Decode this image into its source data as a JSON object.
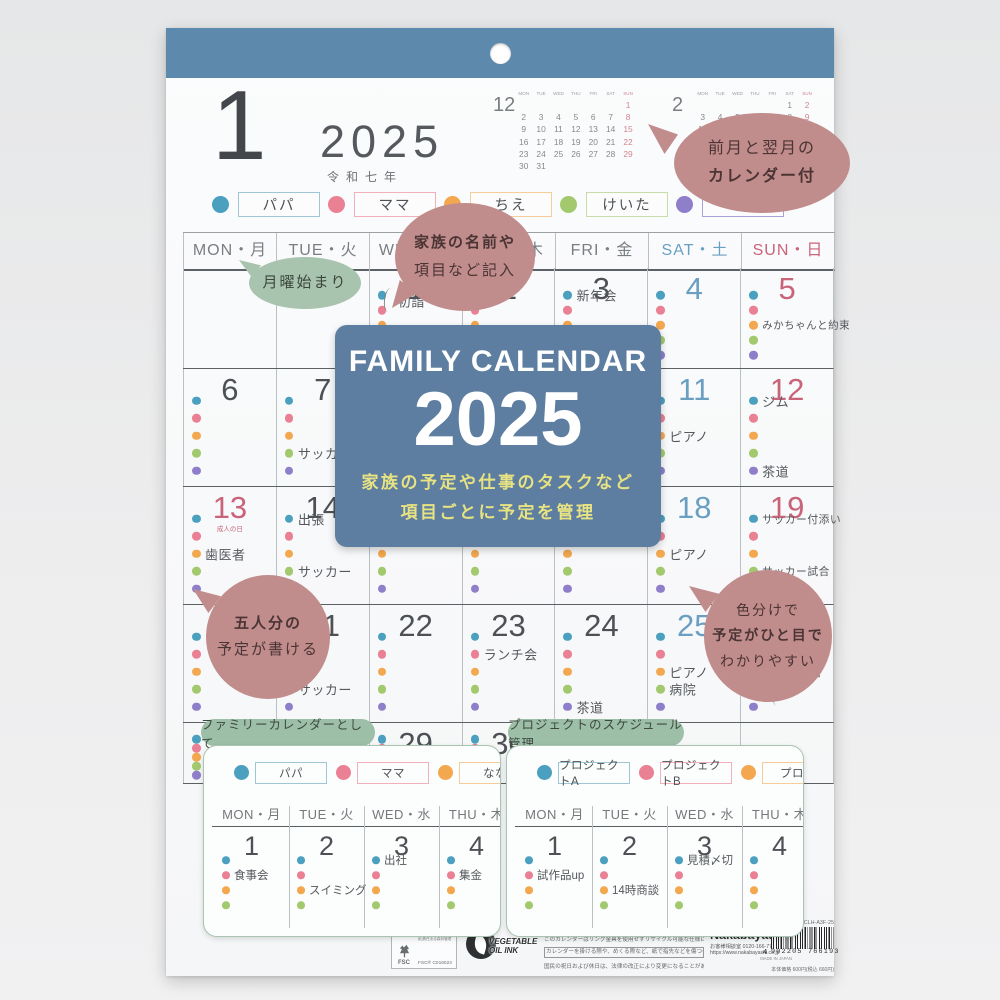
{
  "colors": {
    "strip": "#5d89ac",
    "card": "#5d7ea1",
    "card_accent": "#e7e282",
    "bubble_pink": "#c18c8c",
    "bubble_green": "#a9c4ae",
    "banner_green": "#9dbfa8",
    "members": [
      "#4ba0bf",
      "#ea8093",
      "#f3a74f",
      "#a3c96f",
      "#8f7ec9"
    ],
    "member_boxes": [
      "#9fc6d4",
      "#f2b0bc",
      "#f6cd99",
      "#c7dca6",
      "#a9a2d8"
    ],
    "sat": "#6b9fc2",
    "sun": "#c96379"
  },
  "header": {
    "month": "1",
    "year": "2025",
    "era": "令和七年"
  },
  "mini_calendars": [
    {
      "month": "12",
      "weekdays": [
        "MON",
        "TUE",
        "WED",
        "THU",
        "FRI",
        "SAT",
        "SUN"
      ],
      "weeks": [
        [
          "",
          "",
          "",
          "",
          "",
          "",
          "1"
        ],
        [
          "2",
          "3",
          "4",
          "5",
          "6",
          "7",
          "8"
        ],
        [
          "9",
          "10",
          "11",
          "12",
          "13",
          "14",
          "15"
        ],
        [
          "16",
          "17",
          "18",
          "19",
          "20",
          "21",
          "22"
        ],
        [
          "23",
          "24",
          "25",
          "26",
          "27",
          "28",
          "29"
        ],
        [
          "30",
          "31",
          "",
          "",
          "",
          "",
          ""
        ]
      ]
    },
    {
      "month": "2",
      "weekdays": [
        "MON",
        "TUE",
        "WED",
        "THU",
        "FRI",
        "SAT",
        "SUN"
      ],
      "weeks": [
        [
          "",
          "",
          "",
          "",
          "",
          "1",
          "2"
        ],
        [
          "3",
          "4",
          "5",
          "6",
          "7",
          "8",
          "9"
        ],
        [
          "10",
          "11",
          "12",
          "13",
          "14",
          "15",
          "16"
        ],
        [
          "17",
          "18",
          "19",
          "20",
          "21",
          "22",
          "23"
        ],
        [
          "24",
          "25",
          "26",
          "27",
          "28",
          "",
          ""
        ]
      ]
    }
  ],
  "legend": [
    {
      "label": "パパ"
    },
    {
      "label": "ママ"
    },
    {
      "label": "ちえ"
    },
    {
      "label": "けいた"
    },
    {
      "label": ""
    }
  ],
  "weekday_headers": [
    {
      "en": "MON",
      "jp": "月"
    },
    {
      "en": "TUE",
      "jp": "火"
    },
    {
      "en": "WED",
      "jp": "水"
    },
    {
      "en": "THU",
      "jp": "木"
    },
    {
      "en": "FRI",
      "jp": "金"
    },
    {
      "en": "SAT",
      "jp": "土"
    },
    {
      "en": "SUN",
      "jp": "日"
    }
  ],
  "grid": {
    "holidays": {
      "13": "成人の日"
    },
    "events": {
      "1": [
        {
          "m": 0,
          "text": "初詣",
          "top": 33,
          "left": 28,
          "brace": {
            "top": 20,
            "h": 24,
            "left": 14
          }
        }
      ],
      "3": [
        {
          "m": 0,
          "text": "新年会"
        }
      ],
      "5": [
        {
          "m": 2,
          "text": "みかちゃんと約束",
          "fs": 10.5
        }
      ],
      "7": [
        {
          "m": 3,
          "text": "サッカー"
        }
      ],
      "11": [
        {
          "m": 2,
          "text": "ピアノ"
        }
      ],
      "12": [
        {
          "m": 0,
          "text": "ジム"
        },
        {
          "m": 4,
          "text": "茶道"
        }
      ],
      "13": [
        {
          "m": 2,
          "text": "歯医者"
        }
      ],
      "14": [
        {
          "m": 0,
          "text": "出張"
        },
        {
          "m": 3,
          "text": "サッカー"
        }
      ],
      "18": [
        {
          "m": 2,
          "text": "ピアノ"
        }
      ],
      "19": [
        {
          "m": 0,
          "text": "サッカー付添い",
          "fs": 10.8
        },
        {
          "m": 3,
          "text": "サッカー試合",
          "fs": 10.8
        }
      ],
      "21": [
        {
          "m": 3,
          "text": "サッカー"
        }
      ],
      "23": [
        {
          "m": 1,
          "text": "ランチ会"
        }
      ],
      "24": [
        {
          "m": 4,
          "text": "茶道"
        }
      ],
      "25": [
        {
          "m": 2,
          "text": "ピアノ"
        },
        {
          "m": 3,
          "text": "病院"
        }
      ],
      "26": [
        {
          "m": 2,
          "text": "動物園",
          "fs": 11.5,
          "left": 44,
          "brace": {
            "top": 52,
            "h": 34,
            "left": 32
          }
        }
      ]
    }
  },
  "overlay_card": {
    "title": "FAMILY CALENDAR",
    "year": "2025",
    "line1": "家族の予定や仕事のタスクなど",
    "line2": "項目ごとに予定を管理"
  },
  "bubbles": {
    "prev_next": {
      "lines": [
        "前月と翌月の",
        "カレンダー付"
      ]
    },
    "names": {
      "lines": [
        "家族の名前や",
        "項目など記入"
      ]
    },
    "monday": {
      "lines": [
        "月曜始まり"
      ]
    },
    "five": {
      "lines": [
        "五人分の",
        "予定が書ける"
      ]
    },
    "color": {
      "lines": [
        "色分けで",
        "予定がひと目で",
        "わかりやすい"
      ]
    }
  },
  "banners": [
    "ファミリーカレンダーとして",
    "プロジェクトのスケジュール管理"
  ],
  "cards": [
    {
      "legend": [
        "パパ",
        "ママ",
        "なな"
      ],
      "weekdays": [
        {
          "en": "MON",
          "jp": "月"
        },
        {
          "en": "TUE",
          "jp": "火"
        },
        {
          "en": "WED",
          "jp": "水"
        },
        {
          "en": "THU",
          "jp": "木"
        }
      ],
      "days": [
        {
          "n": "1",
          "events": [
            {
              "m": 1,
              "text": "食事会"
            }
          ]
        },
        {
          "n": "2",
          "events": [
            {
              "m": 2,
              "text": "スイミング"
            }
          ]
        },
        {
          "n": "3",
          "events": [
            {
              "m": 0,
              "text": "出社"
            }
          ]
        },
        {
          "n": "4",
          "events": [
            {
              "m": 1,
              "text": "集金"
            }
          ]
        }
      ]
    },
    {
      "legend": [
        "プロジェクトA",
        "プロジェクトB",
        "プロジ"
      ],
      "weekdays": [
        {
          "en": "MON",
          "jp": "月"
        },
        {
          "en": "TUE",
          "jp": "火"
        },
        {
          "en": "WED",
          "jp": "水"
        },
        {
          "en": "THU",
          "jp": "木"
        }
      ],
      "days": [
        {
          "n": "1",
          "events": [
            {
              "m": 1,
              "text": "試作品up"
            }
          ]
        },
        {
          "n": "2",
          "events": [
            {
              "m": 2,
              "text": "14時商談"
            }
          ]
        },
        {
          "n": "3",
          "events": [
            {
              "m": 0,
              "text": "見積〆切"
            }
          ]
        },
        {
          "n": "4",
          "events": []
        }
      ]
    }
  ],
  "footer": {
    "fsc": {
      "label": "FSC",
      "mix": "ミックス",
      "desc": "紙|責任ある森林管理",
      "cert": "FSC® C016024"
    },
    "ink": {
      "line1": "VEGETABLE",
      "line2": "OIL INK"
    },
    "notes": [
      "【ファミリーカレンダー A3】 ●材質:紙 ●サイズ:297mm×420mm",
      "このカレンダーはリング金具を使用せずリサイクル可能な仕様になっております。",
      "カレンダーを掛ける際や、めくる際など、紙で指先などを傷つけないようにご注意ください。",
      "国民の祝日および休日は、法律の改正により変更になることがあります。"
    ],
    "maker": {
      "name": "Nakabayashi",
      "tel": "お客様相談室 0120-166-779",
      "url": "https://www.nakabayashi.co.jp",
      "origin": "MADE IN JAPAN"
    },
    "barcode": {
      "code": "COC-CLH-A3F-25",
      "lead": "4",
      "digits": "902205 766193",
      "price": "本体価格 600円(税込 660円)"
    }
  }
}
